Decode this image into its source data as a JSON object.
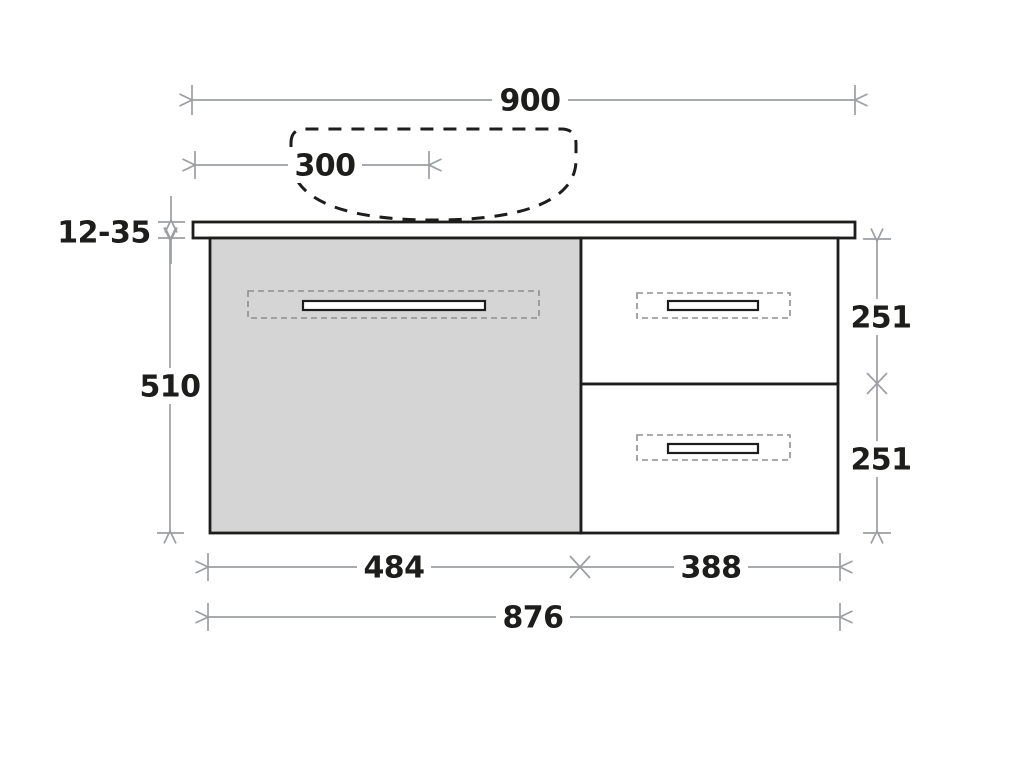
{
  "dims": {
    "overall_width": "900",
    "basin_offset": "300",
    "top_thickness": "12-35",
    "body_height": "510",
    "top_drawer_height": "251",
    "bottom_drawer_height": "251",
    "left_section_width": "484",
    "right_section_width": "388",
    "carcass_width": "876"
  },
  "colors": {
    "ink": "#1d1d1b",
    "dim": "#9b9fa3",
    "panel": "#d5d5d5",
    "paper": "#ffffff",
    "dash": "#8f8f8f"
  }
}
